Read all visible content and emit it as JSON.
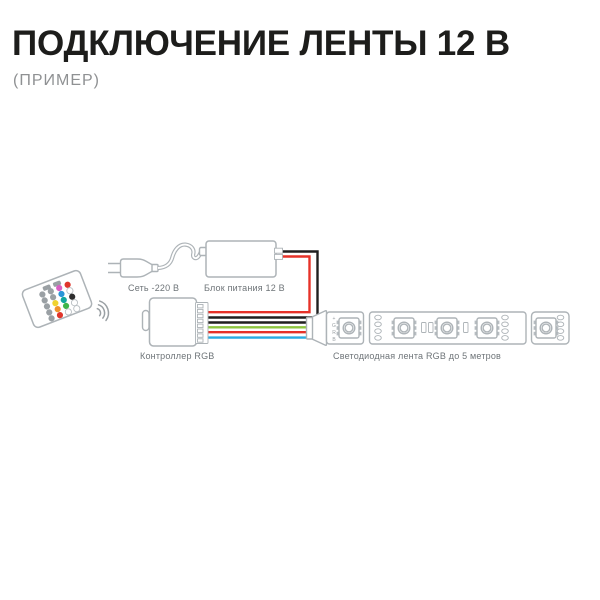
{
  "header": {
    "title": "ПОДКЛЮЧЕНИЕ ЛЕНТЫ 12 В",
    "subtitle": "(ПРИМЕР)"
  },
  "diagram": {
    "labels": {
      "mains": "Сеть -220 В",
      "psu": "Блок питания 12 В",
      "controller": "Контроллер RGB",
      "strip": "Светодиодная лента RGB до 5 метров"
    },
    "strip_pads": [
      "+",
      "G",
      "R",
      "B"
    ],
    "wire_colors": {
      "red": "#e63229",
      "black": "#1f1f1f",
      "green": "#8dc63f",
      "blue": "#29abe2"
    },
    "remote": {
      "key_gray": "#9aa0a4",
      "button_rows": [
        [
          "#9aa0a4",
          "#9aa0a4",
          "#d95fc3",
          "#e0352b"
        ],
        [
          "#9aa0a4",
          "#9aa0a4",
          "#2a95d8",
          "#ffffff"
        ],
        [
          "#9aa0a4",
          "#f0d32f",
          "#11a79c",
          "#2d2d2d"
        ],
        [
          "#9aa0a4",
          "#f0922c",
          "#3fb549",
          "#ffffff"
        ],
        [
          "#9aa0a4",
          "#e0352b",
          "#ffffff",
          "#ffffff"
        ]
      ]
    }
  }
}
